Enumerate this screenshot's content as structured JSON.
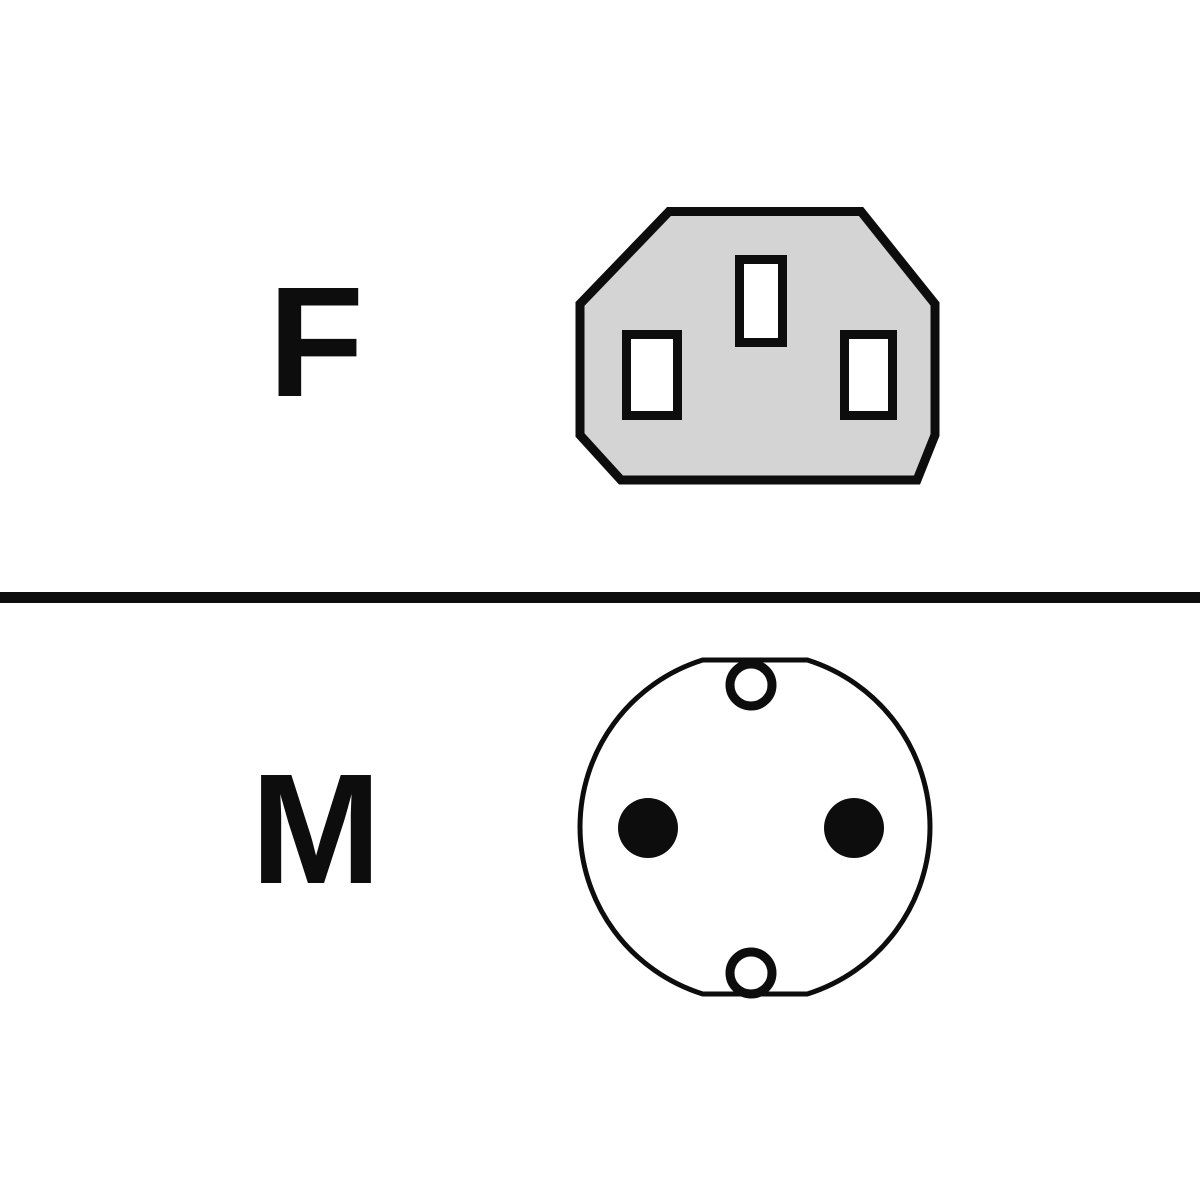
{
  "colors": {
    "background": "#ffffff",
    "ink": "#0d0d0d",
    "connector_body_fill": "#d4d4d4",
    "slot_fill": "#ffffff",
    "ring_fill": "#ffffff",
    "pin_fill": "#0d0d0d"
  },
  "sections": {
    "top": {
      "label": "F",
      "icon": "female-connector-icon"
    },
    "bottom": {
      "label": "M",
      "icon": "male-connector-icon"
    }
  }
}
